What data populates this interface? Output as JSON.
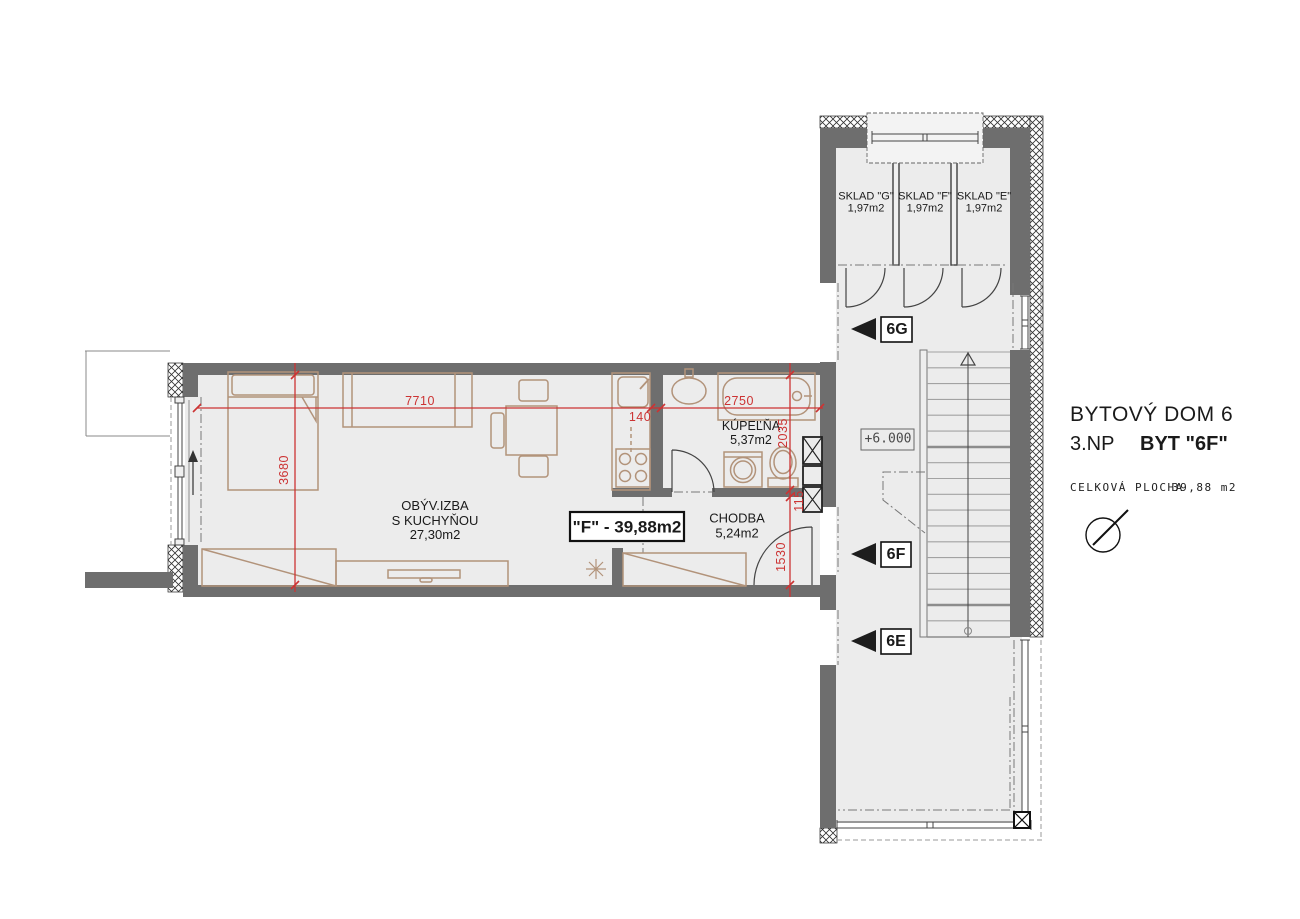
{
  "title": {
    "building": "BYTOVÝ DOM 6",
    "floor": "3.NP",
    "unit": "BYT \"6F\"",
    "area_label": "CELKOVÁ PLOCHA",
    "area_value": "39,88 m2"
  },
  "apartment_tag": "\"F\" - 39,88m2",
  "elevation": "+6.000",
  "rooms": {
    "living": {
      "name_line1": "OBÝV.IZBA",
      "name_line2": "S KUCHYŇOU",
      "area": "27,30m2"
    },
    "bathroom": {
      "name": "KÚPEĽŇA",
      "area": "5,37m2"
    },
    "hall": {
      "name": "CHODBA",
      "area": "5,24m2"
    },
    "storage_g": {
      "name": "SKLAD \"G\"",
      "area": "1,97m2"
    },
    "storage_f": {
      "name": "SKLAD \"F\"",
      "area": "1,97m2"
    },
    "storage_e": {
      "name": "SKLAD \"E\"",
      "area": "1,97m2"
    }
  },
  "door_labels": {
    "g": "6G",
    "f": "6F",
    "e": "6E"
  },
  "dimensions": {
    "living_width": "7710",
    "living_depth": "3680",
    "kitchen_wall": "140",
    "bath_width": "2750",
    "bath_depth": "2035",
    "wall_115": "115",
    "hall_width": "1530"
  },
  "colors": {
    "wall": "#6e6e6e",
    "floor": "#ececec",
    "furniture": "#b2937a",
    "dimension_red": "#cc3333"
  }
}
